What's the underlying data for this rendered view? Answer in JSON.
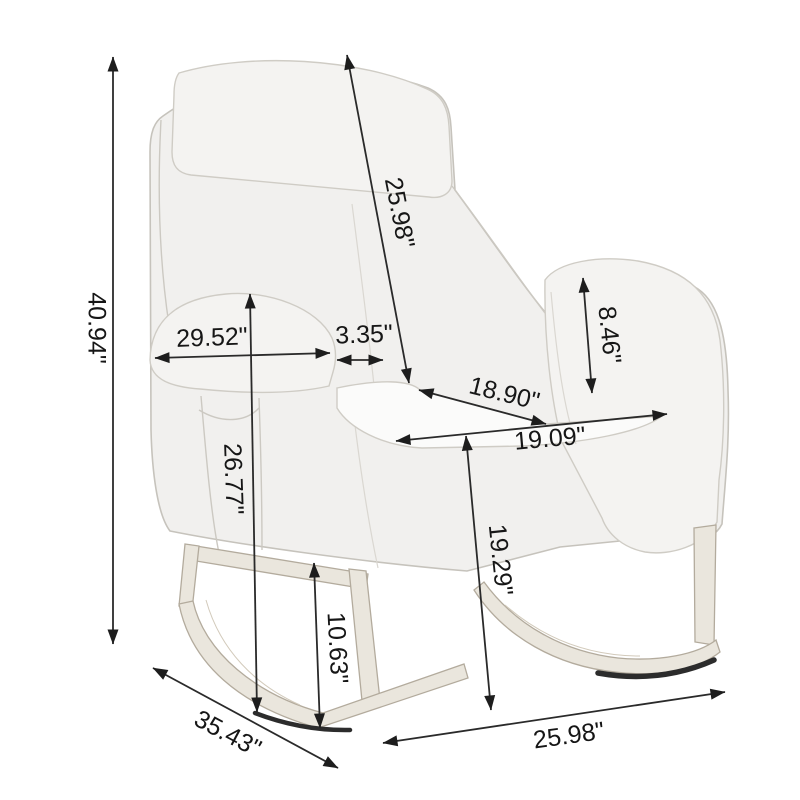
{
  "product": {
    "name": "rocking-chair-dimension-diagram",
    "unit": "inches"
  },
  "dimensions": [
    {
      "id": "overall-height",
      "label": "40.94\""
    },
    {
      "id": "backrest-length",
      "label": "25.98\""
    },
    {
      "id": "upper-depth",
      "label": "29.52\""
    },
    {
      "id": "armrest-top-width",
      "label": "3.35\""
    },
    {
      "id": "armrest-front-height",
      "label": "8.46\""
    },
    {
      "id": "seat-depth",
      "label": "18.90\""
    },
    {
      "id": "seat-width",
      "label": "19.09\""
    },
    {
      "id": "armrest-floor-height",
      "label": "26.77\""
    },
    {
      "id": "seat-floor-height",
      "label": "19.29\""
    },
    {
      "id": "base-height",
      "label": "10.63\""
    },
    {
      "id": "overall-depth",
      "label": "35.43\""
    },
    {
      "id": "overall-width",
      "label": "25.98\""
    }
  ],
  "colors": {
    "background": "#ffffff",
    "fabric": "#f1f0ee",
    "fabric_highlight": "#f4f3f1",
    "seat_light": "#fbfbfa",
    "wood": "#eae6dd",
    "shadow": "#2c2c2c",
    "dimension_line": "#2a2a2a",
    "label_text": "#161616"
  }
}
